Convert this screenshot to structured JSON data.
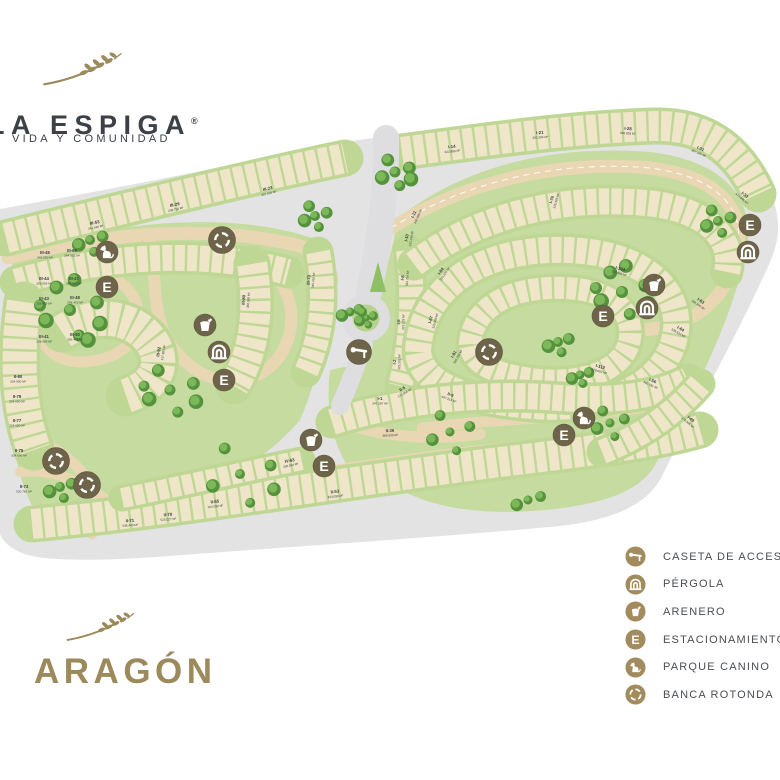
{
  "brand": {
    "name": "LA ESPIGA",
    "registered": "®",
    "tagline": "VIDA Y COMUNIDAD"
  },
  "section": {
    "name": "ARAGÓN"
  },
  "legend": {
    "parking_letter": "E",
    "items": [
      {
        "id": "caseta",
        "label": "CASETA DE ACCESO"
      },
      {
        "id": "pergola",
        "label": "PÉRGOLA"
      },
      {
        "id": "arenero",
        "label": "ARENERO"
      },
      {
        "id": "estacionamiento",
        "label": "ESTACIONAMIENTO"
      },
      {
        "id": "parque-canino",
        "label": "PARQUE CANINO"
      },
      {
        "id": "banca-rotonda",
        "label": "BANCA ROTONDA"
      }
    ]
  },
  "map": {
    "colors": {
      "terrain_gray": "#e3e3e4",
      "road_tan": "#e9d7b4",
      "block_green": "#bfd794",
      "lot_cream": "#efe5c9",
      "tree_green": "#55923c",
      "marker_olive": "#6e6449",
      "legend_gold": "#a28b5d",
      "brand_dark": "#3c4148",
      "section_gold": "#9c8a5c"
    },
    "markers": [
      {
        "type": "dog",
        "x": 107,
        "y": 252
      },
      {
        "type": "parking",
        "x": 107,
        "y": 287
      },
      {
        "type": "rotonda",
        "x": 222,
        "y": 240
      },
      {
        "type": "arenero",
        "x": 205,
        "y": 325
      },
      {
        "type": "pergola",
        "x": 219,
        "y": 352
      },
      {
        "type": "parking",
        "x": 224,
        "y": 380
      },
      {
        "type": "caseta",
        "x": 359,
        "y": 352
      },
      {
        "type": "rotonda",
        "x": 489,
        "y": 352
      },
      {
        "type": "arenero",
        "x": 311,
        "y": 440
      },
      {
        "type": "parking",
        "x": 324,
        "y": 466
      },
      {
        "type": "dog",
        "x": 584,
        "y": 418
      },
      {
        "type": "parking",
        "x": 564,
        "y": 435
      },
      {
        "type": "parking",
        "x": 603,
        "y": 316
      },
      {
        "type": "pergola",
        "x": 647,
        "y": 308
      },
      {
        "type": "arenero",
        "x": 654,
        "y": 285
      },
      {
        "type": "parking",
        "x": 750,
        "y": 225
      },
      {
        "type": "pergola",
        "x": 748,
        "y": 252
      },
      {
        "type": "rotonda",
        "x": 56,
        "y": 461
      },
      {
        "type": "rotonda",
        "x": 87,
        "y": 485
      }
    ],
    "trees": [
      {
        "x": 90,
        "y": 240,
        "n": 4,
        "s": 14,
        "r": 5
      },
      {
        "x": 315,
        "y": 216,
        "n": 5,
        "s": 13,
        "r": 5
      },
      {
        "x": 395,
        "y": 172,
        "n": 6,
        "s": 16,
        "r": 5.5
      },
      {
        "x": 70,
        "y": 310,
        "n": 9,
        "s": 30,
        "r": 6
      },
      {
        "x": 170,
        "y": 390,
        "n": 7,
        "s": 26,
        "r": 5.5
      },
      {
        "x": 350,
        "y": 312,
        "n": 3,
        "s": 10,
        "r": 4.5
      },
      {
        "x": 366,
        "y": 318,
        "n": 5,
        "s": 8,
        "r": 3.8
      },
      {
        "x": 558,
        "y": 342,
        "n": 4,
        "s": 12,
        "r": 5
      },
      {
        "x": 622,
        "y": 292,
        "n": 8,
        "s": 26,
        "r": 6
      },
      {
        "x": 718,
        "y": 221,
        "n": 5,
        "s": 14,
        "r": 5
      },
      {
        "x": 580,
        "y": 375,
        "n": 4,
        "s": 10,
        "r": 4.5
      },
      {
        "x": 610,
        "y": 423,
        "n": 5,
        "s": 16,
        "r": 4.5
      },
      {
        "x": 240,
        "y": 474,
        "n": 6,
        "s": 34,
        "r": 5
      },
      {
        "x": 450,
        "y": 432,
        "n": 5,
        "s": 22,
        "r": 4.5
      },
      {
        "x": 60,
        "y": 487,
        "n": 4,
        "s": 13,
        "r": 5
      },
      {
        "x": 528,
        "y": 500,
        "n": 3,
        "s": 14,
        "r": 4.5
      }
    ],
    "lots": [
      {
        "id": "III-53",
        "area": "341.040 M²",
        "x": 95,
        "y": 224,
        "rot": -12
      },
      {
        "id": "III-29",
        "area": "208.754 M²",
        "x": 175,
        "y": 206,
        "rot": -12
      },
      {
        "id": "III-23",
        "area": "307.595 M²",
        "x": 268,
        "y": 190,
        "rot": -14
      },
      {
        "id": "I-14",
        "area": "322.889 M²",
        "x": 452,
        "y": 148,
        "rot": -6
      },
      {
        "id": "I-21",
        "area": "302.384 M²",
        "x": 540,
        "y": 134,
        "rot": -4
      },
      {
        "id": "I-28",
        "area": "360.833 M²",
        "x": 628,
        "y": 130,
        "rot": 4
      },
      {
        "id": "I-31",
        "area": "367.165 M²",
        "x": 700,
        "y": 150,
        "rot": 24
      },
      {
        "id": "I-33",
        "area": "473.846 M²",
        "x": 744,
        "y": 196,
        "rot": 40
      },
      {
        "id": "III-45",
        "area": "342.050 M²",
        "x": 45,
        "y": 254,
        "rot": 0
      },
      {
        "id": "III-66",
        "area": "264.952 M²",
        "x": 72,
        "y": 252,
        "rot": 0
      },
      {
        "id": "III-44",
        "area": "329.059 M²",
        "x": 44,
        "y": 280,
        "rot": 0
      },
      {
        "id": "III-47",
        "area": "380.000 M²",
        "x": 74,
        "y": 280,
        "rot": 0
      },
      {
        "id": "III-43",
        "area": "329.059 M²",
        "x": 44,
        "y": 300,
        "rot": 0
      },
      {
        "id": "III-48",
        "area": "356.475 M²",
        "x": 75,
        "y": 299,
        "rot": 0
      },
      {
        "id": "III-41",
        "area": "329.059 M²",
        "x": 44,
        "y": 338,
        "rot": 0
      },
      {
        "id": "III-50",
        "area": "356.475 M²",
        "x": 75,
        "y": 336,
        "rot": 0
      },
      {
        "id": "II-80",
        "area": "324.000 M²",
        "x": 18,
        "y": 378,
        "rot": 0
      },
      {
        "id": "II-79",
        "area": "324.000 M²",
        "x": 17,
        "y": 398,
        "rot": 0
      },
      {
        "id": "II-77",
        "area": "324.000 M²",
        "x": 17,
        "y": 422,
        "rot": 0
      },
      {
        "id": "II-75",
        "area": "324.690 M²",
        "x": 19,
        "y": 452,
        "rot": 0
      },
      {
        "id": "II-73",
        "area": "520.781 M²",
        "x": 24,
        "y": 488,
        "rot": 0
      },
      {
        "id": "II-71",
        "area": "546.460 M²",
        "x": 130,
        "y": 522,
        "rot": -4
      },
      {
        "id": "II-70",
        "area": "525.027 M²",
        "x": 168,
        "y": 516,
        "rot": -5
      },
      {
        "id": "III-92",
        "area": "417.993 M²",
        "x": 160,
        "y": 352,
        "rot": -80
      },
      {
        "id": "III-80",
        "area": "368.528 M²",
        "x": 245,
        "y": 300,
        "rot": -85
      },
      {
        "id": "III-73",
        "area": "345.765 M²",
        "x": 310,
        "y": 280,
        "rot": -85
      },
      {
        "id": "I-11",
        "area": "269.886 M²",
        "x": 415,
        "y": 215,
        "rot": -65
      },
      {
        "id": "I-10",
        "area": "323.240 M²",
        "x": 408,
        "y": 238,
        "rot": -80
      },
      {
        "id": "I-8",
        "area": "323.734 M²",
        "x": 404,
        "y": 278,
        "rot": -85
      },
      {
        "id": "I-5",
        "area": "323.203 M²",
        "x": 400,
        "y": 322,
        "rot": -88
      },
      {
        "id": "I-2",
        "area": "323.281 M²",
        "x": 396,
        "y": 362,
        "rot": -88
      },
      {
        "id": "I-1",
        "area": "347.287 M²",
        "x": 380,
        "y": 400,
        "rot": 0
      },
      {
        "id": "I-76",
        "area": "335.486 M²",
        "x": 553,
        "y": 200,
        "rot": -75
      },
      {
        "id": "I-84",
        "area": "325.000 M²",
        "x": 442,
        "y": 272,
        "rot": -55
      },
      {
        "id": "I-87",
        "area": "325.000 M²",
        "x": 432,
        "y": 320,
        "rot": -75
      },
      {
        "id": "I-91",
        "area": "388.268 M²",
        "x": 455,
        "y": 355,
        "rot": -60
      },
      {
        "id": "I-104",
        "area": "392.906 M²",
        "x": 620,
        "y": 270,
        "rot": 15
      },
      {
        "id": "I-105",
        "area": "390.265 M²",
        "x": 648,
        "y": 288,
        "rot": 20
      },
      {
        "id": "I-63",
        "area": "398.800 M²",
        "x": 700,
        "y": 302,
        "rot": 35
      },
      {
        "id": "I-64",
        "area": "335.523 M²",
        "x": 680,
        "y": 330,
        "rot": 30
      },
      {
        "id": "II-36",
        "area": "389.930 M²",
        "x": 390,
        "y": 432,
        "rot": -3
      },
      {
        "id": "II-5",
        "area": "371.066 M²",
        "x": 403,
        "y": 390,
        "rot": -30
      },
      {
        "id": "II-9",
        "area": "457.313 M²",
        "x": 450,
        "y": 396,
        "rot": 20
      },
      {
        "id": "I-112",
        "area": "478.002 M²",
        "x": 600,
        "y": 368,
        "rot": 15
      },
      {
        "id": "I-56",
        "area": "380.031 M²",
        "x": 652,
        "y": 382,
        "rot": 25
      },
      {
        "id": "I-49",
        "area": "370.506 M²",
        "x": 690,
        "y": 420,
        "rot": 40
      },
      {
        "id": "II-53",
        "area": "343.099 M²",
        "x": 335,
        "y": 493,
        "rot": -6
      },
      {
        "id": "II-65",
        "area": "203.094 M²",
        "x": 215,
        "y": 503,
        "rot": -7
      },
      {
        "id": "IV-63",
        "area": "305.594 M²",
        "x": 290,
        "y": 462,
        "rot": -12
      }
    ]
  }
}
